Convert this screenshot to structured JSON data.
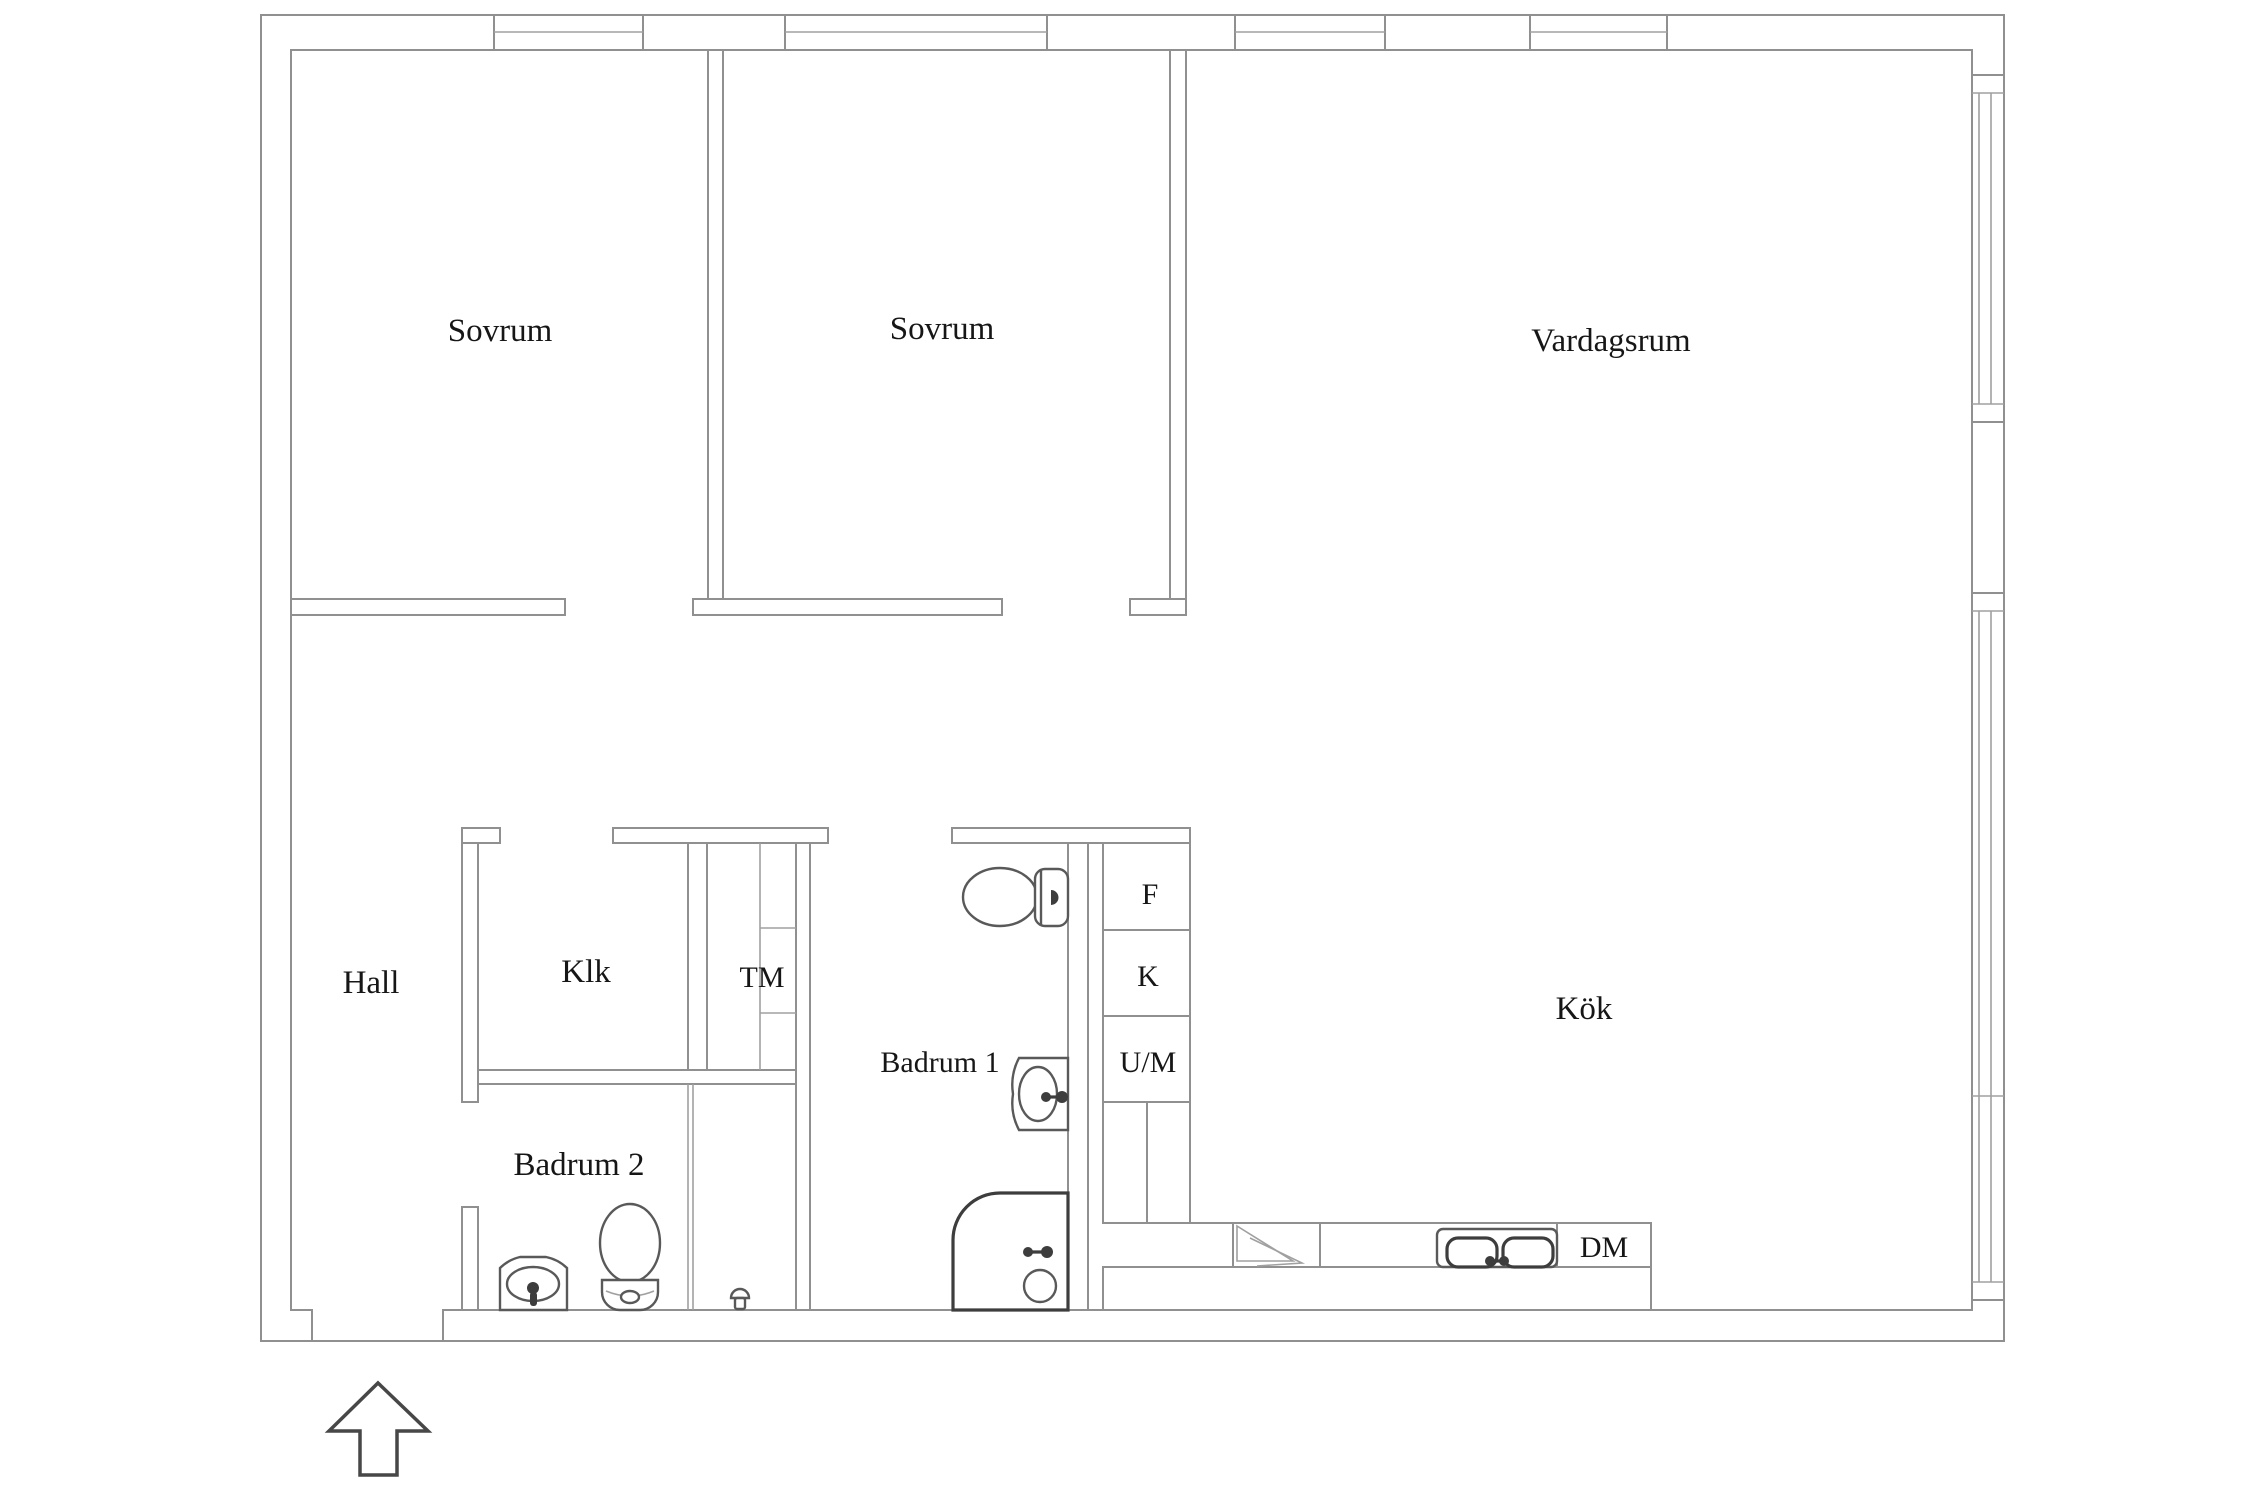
{
  "drawing": {
    "kind": "apartment-floor-plan",
    "background_color": "#ffffff",
    "wall_line_color": "#909090",
    "fixture_line_color": "#4a4a4a",
    "label_color": "#161616"
  },
  "rooms": {
    "sovrum_1": {
      "label": "Sovrum"
    },
    "sovrum_2": {
      "label": "Sovrum"
    },
    "vardagsrum": {
      "label": "Vardagsrum"
    },
    "hall": {
      "label": "Hall"
    },
    "klk": {
      "label": "Klk"
    },
    "tm": {
      "label": "TM"
    },
    "badrum_1": {
      "label": "Badrum 1"
    },
    "badrum_2": {
      "label": "Badrum 2"
    },
    "kok": {
      "label": "Kök"
    }
  },
  "appliances": {
    "freezer": "F",
    "fridge": "K",
    "oven_microwave": "U/M",
    "dishwasher": "DM"
  },
  "fixtures": [
    "toilet-icon",
    "toilet-icon",
    "bathroom-sink-icon",
    "bathroom-sink-icon",
    "bathtub-icon",
    "shower-mixer-icon",
    "kitchen-sink-icon",
    "stove-icon",
    "wardrobe-shelves-icon",
    "entrance-arrow-icon"
  ],
  "windows": {
    "top_wall": 4,
    "right_wall": 2,
    "entrance_opening": 1
  }
}
